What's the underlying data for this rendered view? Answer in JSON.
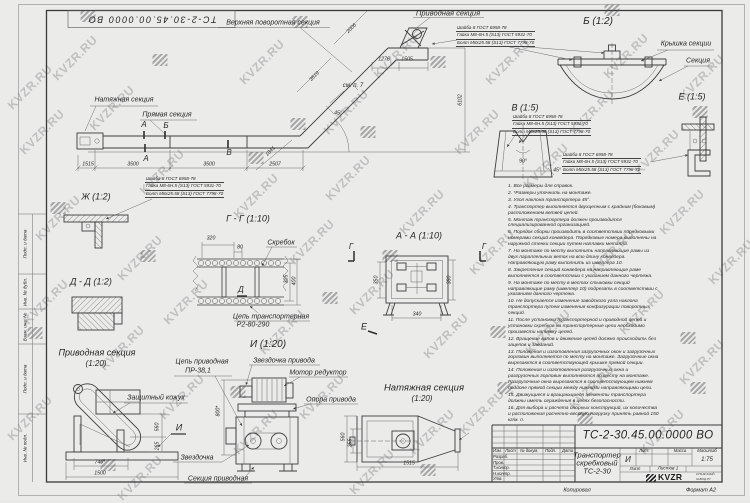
{
  "watermark": {
    "text": "KVZR.RU"
  },
  "frame": {
    "stamp": "ТС-2-30.45.00.0000 ВО",
    "margin_labels": [
      "Подп. и дата",
      "Инв. № дубл.",
      "Взам. инв. №",
      "Подп. и дата",
      "Инв. № подл."
    ],
    "footer_left": "Копировал",
    "footer_right": "Формат А2"
  },
  "main_view": {
    "labels": {
      "tension": "Натяжная секция",
      "straight": "Прямая секция",
      "upper_turn": "Верхняя поворотная секция",
      "drive": "Приводная секция",
      "see_note": "см. п. 7"
    },
    "marks": {
      "a": "А",
      "b": "Б",
      "v": "В"
    },
    "dims": {
      "d1515": "1515",
      "d3500a": "3500",
      "d3500b": "3500",
      "d2507": "2507",
      "d1841": "1841",
      "d2006": "2006",
      "d3519": "3519",
      "d1276": "1276",
      "d1505": "1505",
      "d6102": "6102",
      "angle": "45°"
    }
  },
  "hardware": [
    "Шайба 8 ГОСТ 6958-78",
    "Гайка М8-6Н.5 (S13) ГОСТ 5931-70",
    "Болт М8х25.58 (S13) ГОСТ 7798-70"
  ],
  "details": {
    "b": {
      "title": "Б (1:2)",
      "cover": "Крышка секции",
      "section": "Секция"
    },
    "v": {
      "title": "В (1:5)",
      "angle90": "90°",
      "angle45": "45°"
    },
    "e": {
      "title": "Е (1:5)"
    },
    "zh": {
      "title": "Ж (1:2)"
    },
    "dd": {
      "title": "Д - Д (1:2)"
    },
    "gg": {
      "title": "Г - Г (1:10)",
      "scraper": "Скребок",
      "chain1": "Цепь транспортерная",
      "chain2": "Р2-80-290",
      "d320": "320",
      "d80": "80",
      "d305": "305",
      "d400": "400",
      "mark_d": "Д"
    },
    "aa": {
      "title": "А - А (1:10)",
      "mark_g": "Г",
      "mark_e": "Е",
      "d350": "350",
      "d380": "380",
      "d340": "340"
    },
    "drive_section": {
      "title": "Приводная секция",
      "scale": "(1:20)",
      "guard": "Защитный кожух",
      "mark_i": "И",
      "d560": "560",
      "d265": "265",
      "d740": "740*",
      "d1500": "1500"
    },
    "i_view": {
      "title": "И (1:20)",
      "chain1": "Цепь приводная",
      "chain2": "ПР-38,1",
      "sprocket_drive": "Звездочка привода",
      "motor": "Мотор редуктор",
      "support": "Опора привода",
      "sprocket": "Звездочка",
      "section": "Секция приводная",
      "d800": "800*"
    },
    "tension_section": {
      "title": "Натяжная секция",
      "scale": "(1:20)",
      "d1515": "1515",
      "d560": "560",
      "d255": "255"
    }
  },
  "notes": [
    "1. Все размеры для справок.",
    "2. *Размеры уточнить на монтаже.",
    "3. Угол наклона транспортера 45°.",
    "4. Транспортер выполняется двухцепным с крайним (боковым) расположением ветвей цепей.",
    "5. Монтаж транспортера должен производится специализированной организацией.",
    "6. Порядок сборки производить в соответствии порядковыми номерами секций конвейера. Порядковые номера выполнены на наружной стенки секции путем наплавки металла.",
    "7. На монтаже по месту выполнить направляющие рамы из двух параллельных веток на всю длину конвейера. Направляющую раму выполнить из швеллера 10.",
    "8. Закрепление секций конвейера на направляющие раме выполняется в соответствии с указанием данного чертежа.",
    "9. На монтаже по месту в местах стыковки секций направляющие раму (швеллер 10) подрезать в соответствии с указанием данного чертежа.",
    "10. Не допускается изменение заводского угла наклона транспортера путем изменения конфигурации поворотных секций.",
    "11. После установки транспортерной и приводной цепей и установки скребков на транспортерные цепи необходимо произвести натяжку цепей.",
    "12. Вращение валов и движение цепей должно происходить без зацепов и заеданий.",
    "13. Положения и изготовления загрузочных окон и загрузочных горловин выполняется по месту на монтаже. Загрузочные окна вырезаются в соответствующей крышке прямой секции.",
    "14. Положения и изготовления разгрузочных окна и разгрузочных горловин выполняются по месту на монтаже. Разгрузочные окна вырезаются в соответствующем нижнем поддоне прямой секции между нижними направляющими цепи.",
    "15. Движущиеся и вращающиеся элементы транспортера должны иметь ограждения в целях безопасности.",
    "16. Для выбора и расчета опорных конструкций, их количества и расположения расчетно-весовую нагрузку принять равной 150 кг/м. п."
  ],
  "title_block": {
    "designation": "ТС-2-30.45.00.0000 ВО",
    "name1": "Транспортер",
    "name2": "скребковый",
    "name3": "ТС-2-30",
    "lit_header": "Лит.",
    "mass_header": "Масса",
    "scale_header": "Масштаб",
    "lit": "И",
    "scale": "1:75",
    "sheet_header": "Лист",
    "sheets": "Листов 1",
    "logo": "KVZR",
    "logo_sub1": "КУЗНЕЧНЫЙ",
    "logo_sub2": "ЗАВОД.РУ",
    "col_izm": "Изм.",
    "col_list": "Лист",
    "col_doc": "№ докум.",
    "col_sign": "Подп.",
    "col_date": "Дата",
    "rows": [
      "Разраб.",
      "Пров.",
      "Т.контр.",
      "Н.контр.",
      "Утв."
    ]
  }
}
